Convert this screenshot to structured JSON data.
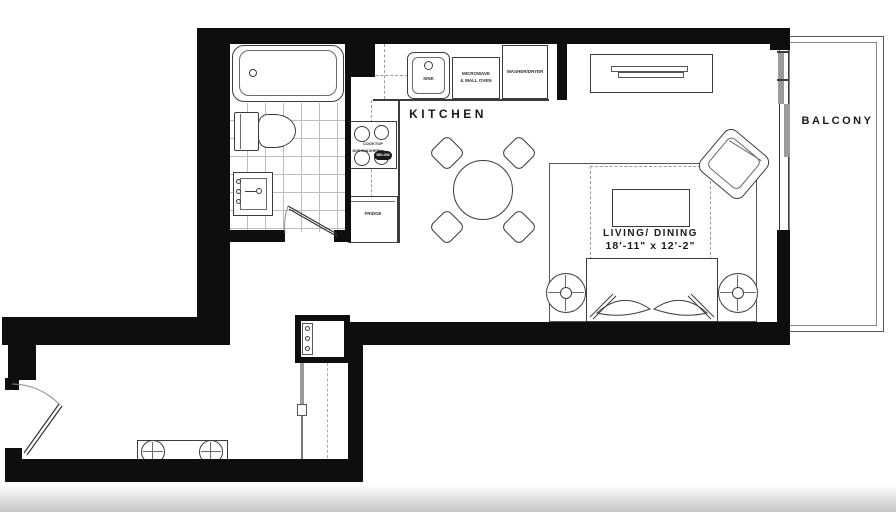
{
  "rooms": {
    "kitchen": "KITCHEN",
    "living": {
      "name": "LIVING/ DINING",
      "dimensions": "18'-11\" x 12'-2\""
    },
    "balcony": "BALCONY"
  },
  "fixtures": {
    "sink": "SINK",
    "microwave_line1": "MICROWAVE",
    "microwave_line2": "& WALL OVEN",
    "washer_dryer": "WASHER/DRYER",
    "cooktop": "COOKTOP",
    "dishwasher": "DISHWASHER",
    "dishwasher_tag": "BELOW",
    "fridge": "FRIDGE"
  },
  "colors": {
    "wall": "#0e0e0e",
    "line": "#3c3c3c",
    "tile": "#bdbdbd",
    "slider_gray": "#9a9a9a"
  }
}
